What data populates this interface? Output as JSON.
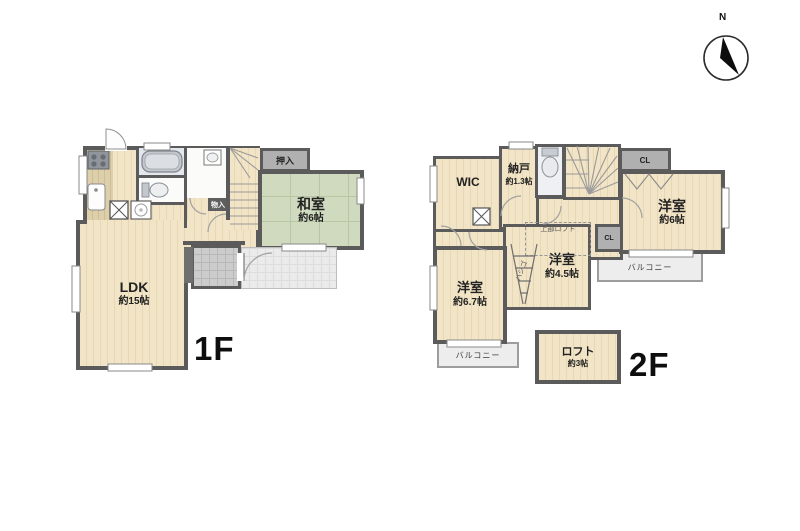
{
  "compass": {
    "north": "N"
  },
  "floor1": {
    "label": "1F",
    "ldk": {
      "name": "LDK",
      "size": "約15帖"
    },
    "washitsu": {
      "name": "和室",
      "size": "約6帖"
    },
    "oshiire": "押入",
    "monoire": "物入"
  },
  "floor2": {
    "label": "2F",
    "wic": "WIC",
    "nando": {
      "name": "納戸",
      "size": "約1.3帖"
    },
    "cl_top": "CL",
    "cl_mid": "CL",
    "room6": {
      "name": "洋室",
      "size": "約6帖"
    },
    "room45": {
      "name": "洋室",
      "size": "約4.5帖"
    },
    "room67": {
      "name": "洋室",
      "size": "約6.7帖"
    },
    "loft": {
      "name": "ロフト",
      "size": "約3帖"
    },
    "balcony_right": "バルコニー",
    "balcony_left": "バルコニー",
    "upper_loft": "上部ロフト",
    "ladder": "ハシゴ"
  },
  "colors": {
    "wall": "#5b5b5b",
    "wood_floor": "#f2e4c6",
    "kitchen_floor": "#d8cba6",
    "tatami": "#d0dabf",
    "closet_gray": "#b0b0b0",
    "balcony_gray": "#ededed",
    "bath": "#e4e8ed"
  }
}
